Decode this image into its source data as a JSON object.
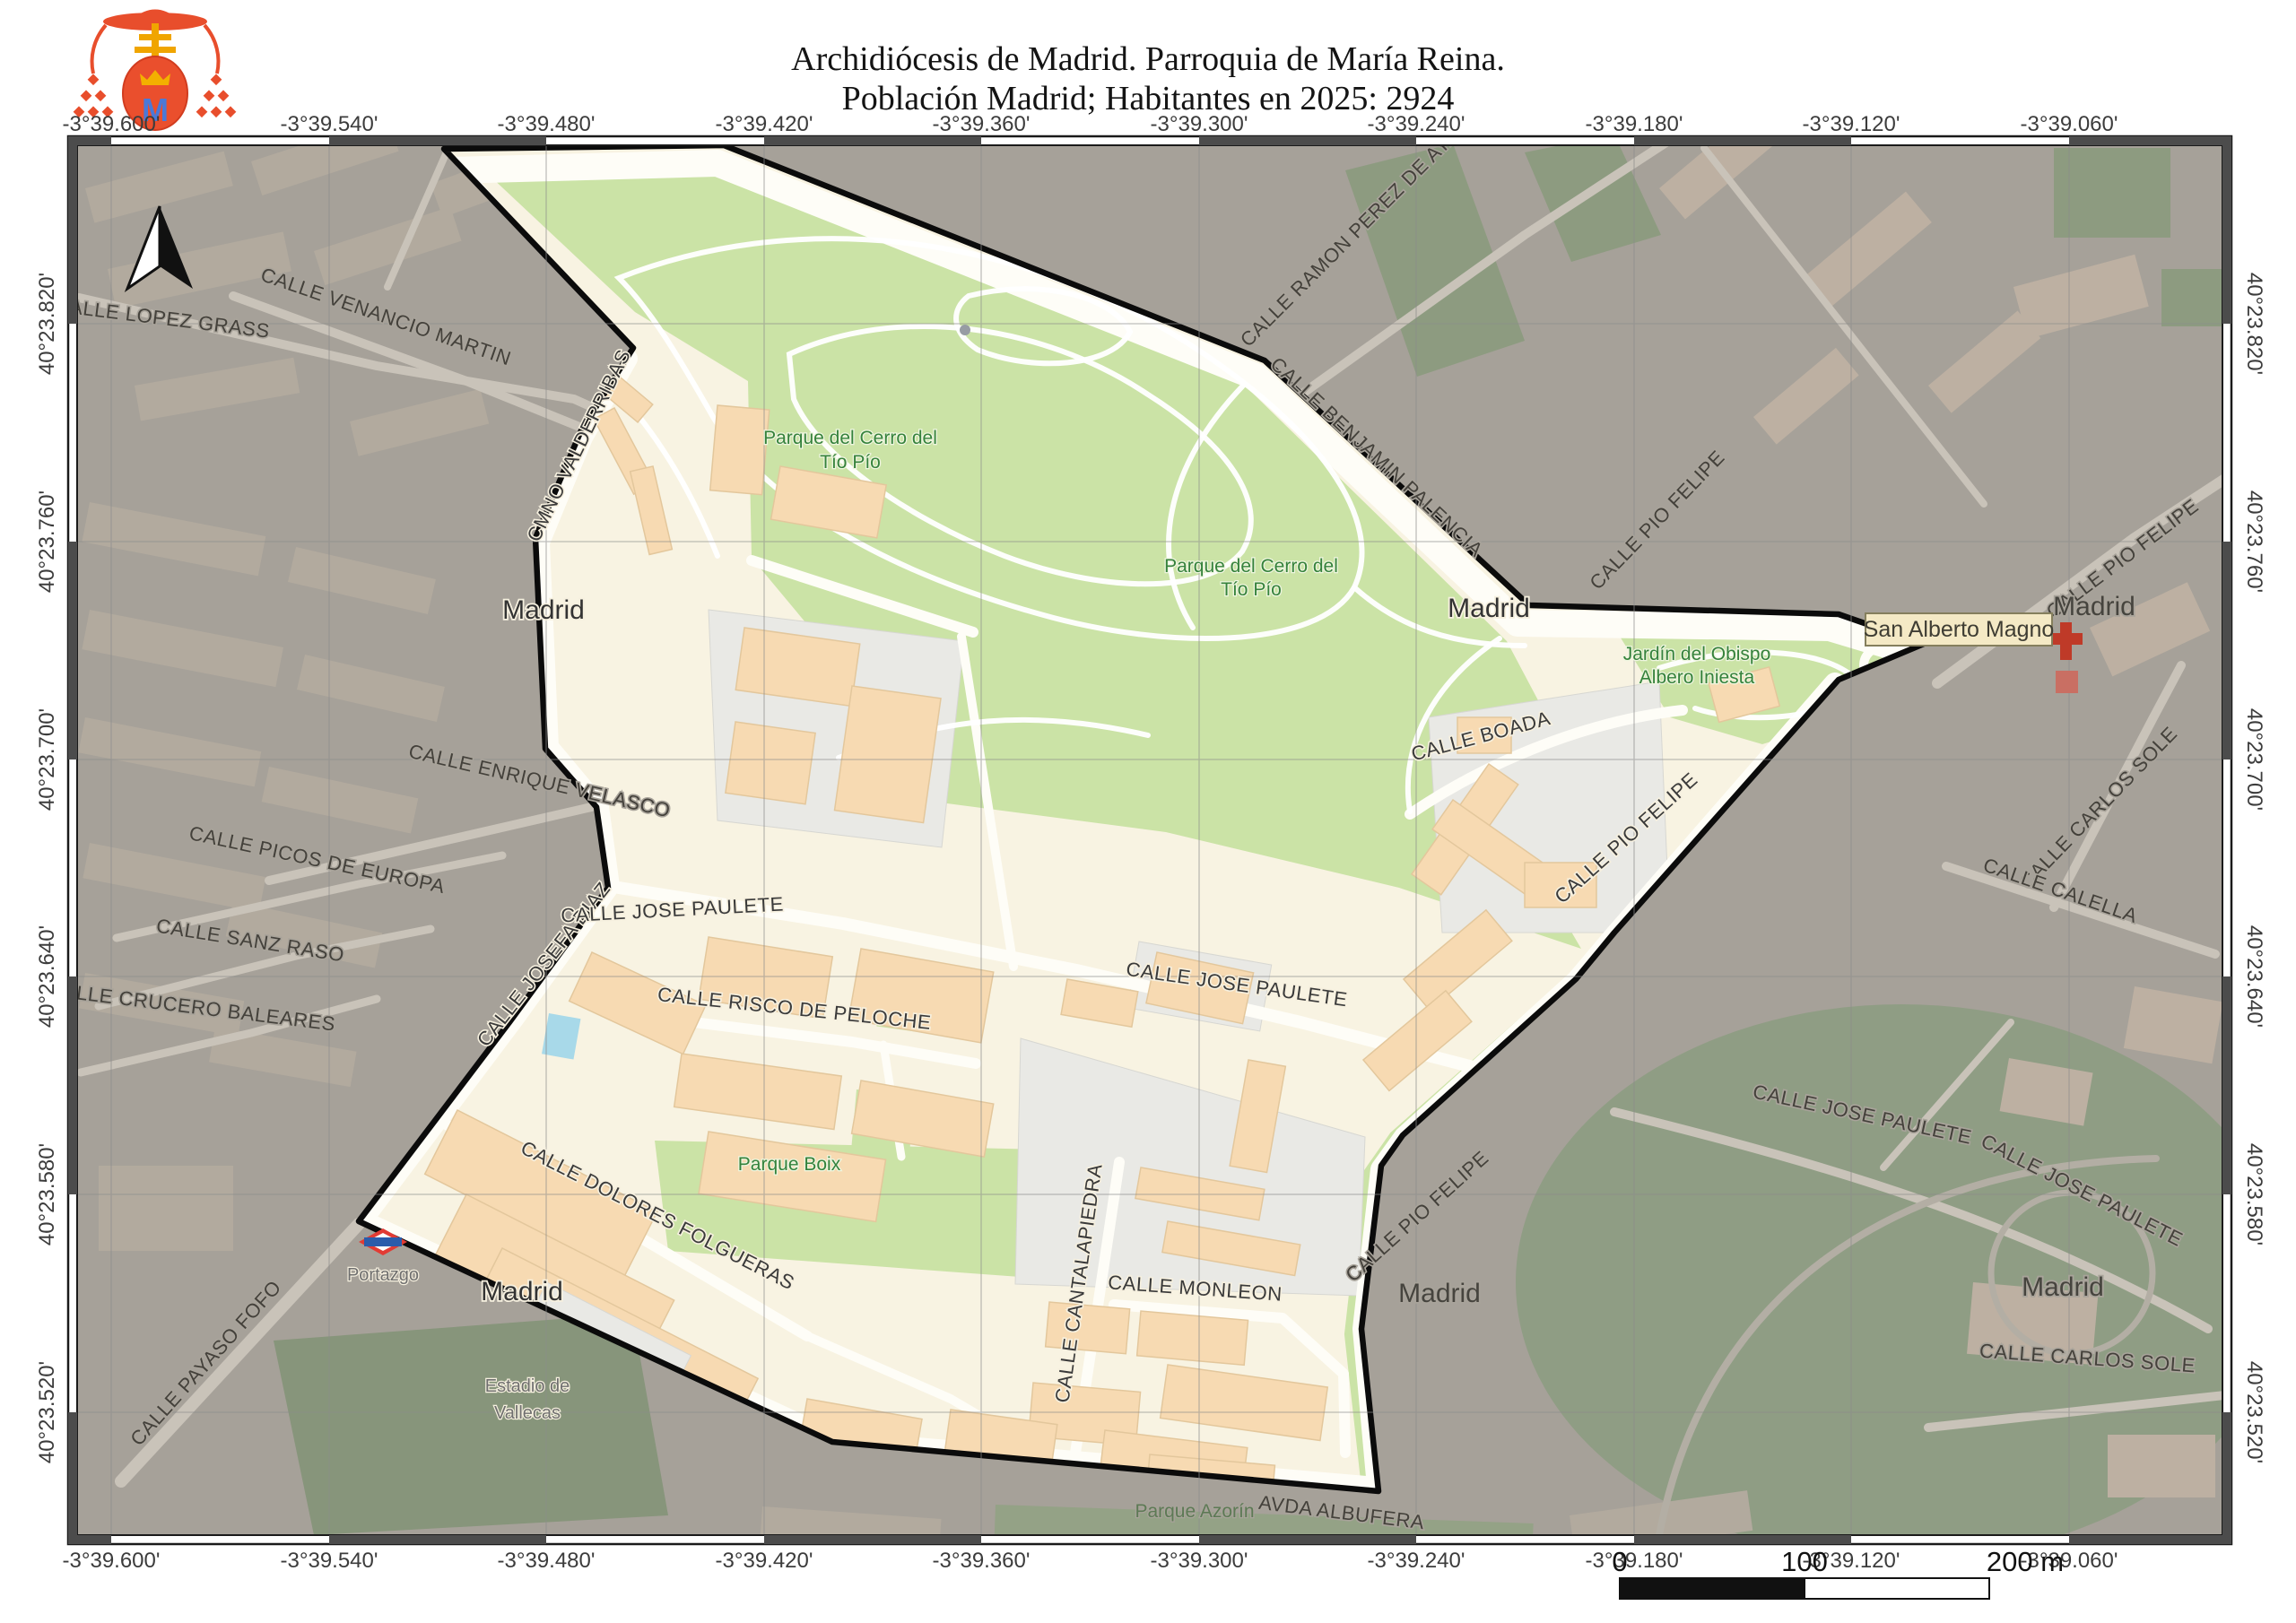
{
  "header": {
    "title_line1": "Archidiócesis de Madrid. Parroquia de María Reina.",
    "title_line2": "Población Madrid; Habitantes en 2025: 2924"
  },
  "logo": {
    "monogram": "M"
  },
  "grid": {
    "top": [
      "-3°39.600'",
      "-3°39.540'",
      "-3°39.480'",
      "-3°39.420'",
      "-3°39.360'",
      "-3°39.300'",
      "-3°39.240'",
      "-3°39.180'",
      "-3°39.120'",
      "-3°39.060'"
    ],
    "bottom": [
      "-3°39.600'",
      "-3°39.540'",
      "-3°39.480'",
      "-3°39.420'",
      "-3°39.360'",
      "-3°39.300'",
      "-3°39.240'",
      "-3°39.180'",
      "-3°39.120'",
      "-3°39.060'"
    ],
    "left": [
      "40°23.820'",
      "40°23.760'",
      "40°23.700'",
      "40°23.640'",
      "40°23.580'",
      "40°23.520'"
    ],
    "right": [
      "40°23.820'",
      "40°23.760'",
      "40°23.700'",
      "40°23.640'",
      "40°23.580'",
      "40°23.520'"
    ]
  },
  "streets": {
    "lopez_grass": "CALLE LOPEZ GRASS",
    "venancio_martin": "CALLE VENANCIO MARTIN",
    "ramon_perez": "CALLE RAMON PEREZ DE AYALA",
    "benjamin_palencia": "CALLE BENJAMIN PALENCIA",
    "valderribas": "CMNO VALDERRIBAS",
    "pio_felipe": "CALLE PIO FELIPE",
    "enrique_velasco": "CALLE ENRIQUE VELASCO",
    "picos_europa": "CALLE PICOS DE EUROPA",
    "sanz_raso": "CALLE SANZ RASO",
    "crucero_baleares": "CALLE CRUCERO BALEARES",
    "josefa_diaz": "CALLE JOSEFA DIAZ",
    "jose_paulete": "CALLE JOSE PAULETE",
    "risco_peloche": "CALLE RISCO DE PELOCHE",
    "boada": "CALLE BOADA",
    "dolores_folgueras": "CALLE DOLORES FOLGUERAS",
    "cantalapiedra": "CALLE CANTALAPIEDRA",
    "monleon": "CALLE MONLEON",
    "albufera": "AVDA ALBUFERA",
    "payaso_fofo": "CALLE PAYASO FOFO",
    "carlos_sole": "CALLE CARLOS SOLE",
    "calella": "CALLE CALELLA"
  },
  "places": {
    "madrid": "Madrid",
    "portazgo": "Portazgo",
    "estadio_line1": "Estadio de",
    "estadio_line2": "Vallecas",
    "parque_azorin": "Parque Azorín",
    "parque_boix": "Parque Boix",
    "cerro_line1": "Parque del Cerro del",
    "cerro_line2": "Tío Pío",
    "jardin_line1": "Jardín del Obispo",
    "jardin_line2": "Albero Iniesta"
  },
  "poi": {
    "san_alberto": "San Alberto Magno"
  },
  "scalebar": {
    "start": "0",
    "middle": "100",
    "end": "200 m"
  },
  "colors": {
    "parish_fill": "#f8f3e2",
    "park_green": "#cbe3a6",
    "building": "#f7dab2",
    "outside_dim": "#a6a199",
    "outside_green": "#8d9b80",
    "boundary": "#000000",
    "marker_red": "#bf3a28",
    "tooltip_bg": "#f4e9c5",
    "pool_blue": "#a8d9e9"
  }
}
